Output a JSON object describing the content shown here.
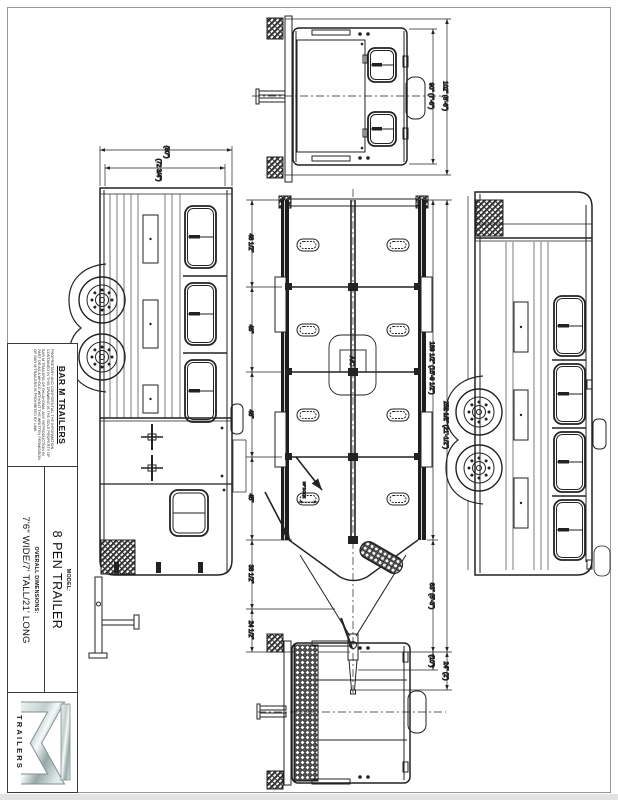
{
  "title_block": {
    "company": "BAR M TRAILERS",
    "proprietary": "PROPRIETARY AND CONFIDENTIAL THE INFORMATION CONTAINED IN THIS DRAWING IS THE SOLE PROPERTY OF BAR M TRAILERS OF OKLAHOMA. ANY REPRODUCTION IN PART OR AS A WHOLE WITHOUT THE WRITTEN PERMISSION OF BAR M TRAILERS IS PROHIBITED BY LAW.",
    "model_label": "MODEL:",
    "model": "8 PEN TRAILER",
    "overall_label": "OVERALL DIMENSIONS:",
    "overall": "7'6\" WIDE/7' TALL/21' LONG",
    "logo_text": "TRAILERS"
  },
  "dims": {
    "front": {
      "inner": "90\" (7'-6\")",
      "outer": "102\" (8'-6\")"
    },
    "side": {
      "outer": "(80\")",
      "inner": "(72 3/4\")"
    },
    "plan": {
      "left": [
        "48 1/2\"",
        "48\"",
        "48\"",
        "45\"",
        "38 1/2\"",
        "24 1/2\""
      ],
      "box": "189 1/2\" (15'-9 1/2\")",
      "overall": "252 1/2\" (21'-1/2\")",
      "nose": "63\" (5'-3\")",
      "tongue": "24\" (2')",
      "coupler": "(10\")",
      "door": "36\" DOOR",
      "ac": "A/C"
    }
  },
  "colors": {
    "line": "#222222",
    "chrome_mid": "#c2cfce",
    "logo_text": "#667878"
  }
}
